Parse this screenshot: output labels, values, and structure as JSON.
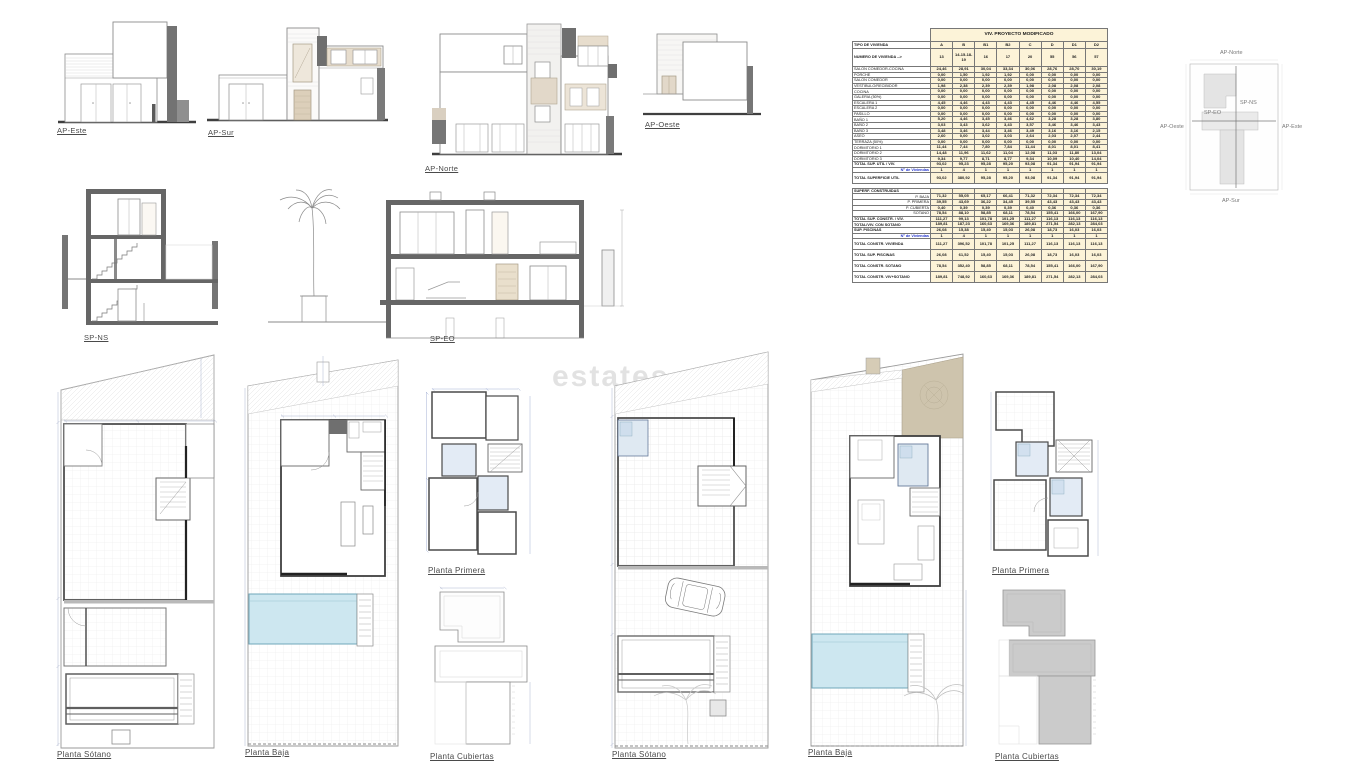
{
  "watermark": {
    "text": "estates.c"
  },
  "elevations": [
    {
      "label": "AP-Este"
    },
    {
      "label": "AP-Sur"
    },
    {
      "label": "AP-Norte"
    },
    {
      "label": "AP-Oeste"
    }
  ],
  "sections": [
    {
      "label": "SP-NS"
    },
    {
      "label": "SP-EO"
    }
  ],
  "site_key": {
    "north": "AP-Norte",
    "south": "AP-Sur",
    "west": "AP-Oeste",
    "east": "AP-Este",
    "section_vertical": "SP-NS",
    "section_horizontal": "SP-EO"
  },
  "plans": [
    {
      "label": "Planta Sótano"
    },
    {
      "label": "Planta Baja"
    },
    {
      "label": "Planta Primera"
    },
    {
      "label": "Planta Cubiertas"
    },
    {
      "label": "Planta Sótano"
    },
    {
      "label": "Planta Baja"
    },
    {
      "label": "Planta Primera"
    },
    {
      "label": "Planta Cubiertas"
    }
  ],
  "colors": {
    "table_fill": "#fcf3d8",
    "pool_blue": "#cde7f0",
    "tan": "#cec4ad",
    "wall_dark": "#666666",
    "accent_blue_text": "#2233cc"
  },
  "table": {
    "title": "VIV. PROYECTO MODIFICADO",
    "type_label": "TIPO DE VIVIENDA",
    "columns": [
      "A",
      "B",
      "B1",
      "B2",
      "C",
      "D",
      "D1",
      "D2"
    ],
    "numero_label": "NUMERO DE VIVIENDA -->",
    "numeros": [
      "13",
      "14-15-18-19",
      "16",
      "17",
      "20",
      "55",
      "56",
      "57"
    ],
    "rows": [
      {
        "label": "SALON COMEDOR-COCINA",
        "style": "normal",
        "values": [
          "24,46",
          "28,91",
          "30,04",
          "33,34",
          "30,06",
          "28,76",
          "28,70",
          "30,19"
        ]
      },
      {
        "label": "PORCHE",
        "style": "normal",
        "values": [
          "0,00",
          "1,50",
          "1,92",
          "1,92",
          "0,00",
          "0,00",
          "0,00",
          "0,00"
        ]
      },
      {
        "label": "SALON COMEDOR",
        "style": "normal",
        "values": [
          "0,00",
          "0,00",
          "0,00",
          "0,00",
          "0,00",
          "0,00",
          "0,00",
          "0,00"
        ]
      },
      {
        "label": "VESTIBULO/RECIBIDOR",
        "style": "normal",
        "values": [
          "1,98",
          "2,38",
          "2,39",
          "2,39",
          "1,98",
          "2,08",
          "2,08",
          "2,08"
        ]
      },
      {
        "label": "COCINA",
        "style": "normal",
        "values": [
          "0,00",
          "0,00",
          "0,00",
          "0,00",
          "0,00",
          "0,00",
          "0,00",
          "0,00"
        ]
      },
      {
        "label": "GALERIA (50%)",
        "style": "normal",
        "values": [
          "0,00",
          "0,00",
          "0,00",
          "0,00",
          "0,00",
          "0,00",
          "0,00",
          "0,00"
        ]
      },
      {
        "label": "ESCALERA 1",
        "style": "normal",
        "values": [
          "4,45",
          "4,46",
          "4,43",
          "4,43",
          "4,45",
          "4,46",
          "4,46",
          "4,55"
        ]
      },
      {
        "label": "ESCALERA 2",
        "style": "normal",
        "values": [
          "0,00",
          "0,00",
          "0,00",
          "0,00",
          "0,00",
          "0,00",
          "0,00",
          "0,00"
        ]
      },
      {
        "label": "PASILLO",
        "style": "normal",
        "values": [
          "0,00",
          "0,00",
          "0,00",
          "0,00",
          "0,00",
          "0,00",
          "0,00",
          "0,00"
        ]
      },
      {
        "label": "BAÑO 1",
        "style": "normal",
        "values": [
          "5,20",
          "4,46",
          "3,45",
          "3,46",
          "4,62",
          "3,28",
          "3,28",
          "3,80"
        ]
      },
      {
        "label": "BAÑO 2",
        "style": "normal",
        "values": [
          "3,03",
          "3,43",
          "3,62",
          "3,43",
          "3,57",
          "3,46",
          "3,46",
          "3,43"
        ]
      },
      {
        "label": "BAÑO 3",
        "style": "normal",
        "values": [
          "3,48",
          "3,46",
          "3,44",
          "3,46",
          "3,49",
          "3,16",
          "3,16",
          "2,15"
        ]
      },
      {
        "label": "ASEO",
        "style": "normal",
        "values": [
          "2,60",
          "0,00",
          "3,02",
          "3,03",
          "2,64",
          "2,03",
          "2,07",
          "2,44"
        ]
      },
      {
        "label": "TERRAZA (50%)",
        "style": "normal",
        "values": [
          "0,00",
          "0,00",
          "0,00",
          "0,00",
          "0,00",
          "0,00",
          "0,00",
          "0,00"
        ]
      },
      {
        "label": "DORMITORIO 1",
        "style": "normal",
        "values": [
          "11,44",
          "7,44",
          "7,80",
          "7,84",
          "11,44",
          "8,01",
          "8,01",
          "8,41"
        ]
      },
      {
        "label": "DORMITORIO 2",
        "style": "normal",
        "values": [
          "14,48",
          "11,96",
          "11,62",
          "11,04",
          "12,08",
          "11,03",
          "11,80",
          "13,04"
        ]
      },
      {
        "label": "DORMITORIO 3",
        "style": "normal",
        "values": [
          "9,34",
          "9,77",
          "8,71",
          "8,77",
          "9,34",
          "10,09",
          "10,40",
          "14,04"
        ]
      },
      {
        "label": "TOTAL SUP. UTIL / VIV.",
        "style": "total",
        "values": [
          "93,02",
          "95,23",
          "95,28",
          "95,20",
          "93,08",
          "91,34",
          "91,94",
          "91,94"
        ]
      },
      {
        "label": "Nº de Viviendas",
        "style": "blue",
        "values": [
          "1",
          "4",
          "1",
          "1",
          "1",
          "1",
          "1",
          "1"
        ]
      },
      {
        "label": "TOTAL SUPERFICIE UTIL",
        "style": "total tall",
        "values": [
          "93,02",
          "380,92",
          "95,28",
          "95,20",
          "93,08",
          "91,34",
          "91,94",
          "91,94"
        ]
      },
      {
        "label": "",
        "style": "spacer",
        "values": [
          "",
          "",
          "",
          "",
          "",
          "",
          "",
          ""
        ]
      },
      {
        "label": "SUPERF. CONSTRUIDAS",
        "style": "section",
        "values": [
          "",
          "",
          "",
          "",
          "",
          "",
          "",
          ""
        ]
      },
      {
        "label": "P. BAJA",
        "style": "sub",
        "values": [
          "71,32",
          "55,05",
          "65,17",
          "66,41",
          "71,32",
          "72,34",
          "72,34",
          "72,34"
        ]
      },
      {
        "label": "P. PRIMERA",
        "style": "sub",
        "values": [
          "39,55",
          "43,69",
          "36,22",
          "34,45",
          "39,55",
          "43,43",
          "43,43",
          "43,43"
        ]
      },
      {
        "label": "P. CUBIERTA",
        "style": "sub",
        "values": [
          "0,40",
          "0,39",
          "0,39",
          "0,39",
          "0,40",
          "0,36",
          "0,36",
          "0,36"
        ]
      },
      {
        "label": "SOTANO",
        "style": "sub",
        "values": [
          "78,54",
          "88,10",
          "58,85",
          "68,11",
          "78,54",
          "155,41",
          "166,00",
          "167,90"
        ]
      },
      {
        "label": "TOTAL SUP. CONSTR. / VIV.",
        "style": "total",
        "values": [
          "111,27",
          "99,13",
          "101,78",
          "101,25",
          "111,27",
          "116,13",
          "116,13",
          "116,13"
        ]
      },
      {
        "label": "TOTAL/VIV. CON SOTANO",
        "style": "total",
        "values": [
          "189,81",
          "187,23",
          "160,63",
          "169,36",
          "189,81",
          "271,54",
          "282,13",
          "284,03"
        ]
      },
      {
        "label": "SUP. PISCINAS",
        "style": "total",
        "values": [
          "26,08",
          "15,38",
          "15,40",
          "15,03",
          "26,08",
          "18,73",
          "16,03",
          "16,03"
        ]
      },
      {
        "label": "Nº de Viviendas",
        "style": "blue",
        "values": [
          "1",
          "4",
          "1",
          "1",
          "1",
          "1",
          "1",
          "1"
        ]
      },
      {
        "label": "TOTAL CONSTR. VIVIENDA",
        "style": "total tall",
        "values": [
          "111,27",
          "396,52",
          "101,78",
          "101,25",
          "111,27",
          "116,13",
          "116,13",
          "116,13"
        ]
      },
      {
        "label": "TOTAL SUP. PISCINAS",
        "style": "total tall",
        "values": [
          "26,08",
          "61,52",
          "15,40",
          "15,03",
          "26,08",
          "18,73",
          "16,03",
          "16,03"
        ]
      },
      {
        "label": "TOTAL CONSTR. SOTANO",
        "style": "total tall",
        "values": [
          "78,54",
          "352,40",
          "58,85",
          "68,11",
          "78,54",
          "155,41",
          "166,00",
          "167,90"
        ]
      },
      {
        "label": "TOTAL CONSTR. VIV+SOTANO",
        "style": "total tall",
        "values": [
          "189,81",
          "748,92",
          "160,63",
          "169,36",
          "189,81",
          "271,54",
          "282,13",
          "284,03"
        ]
      }
    ]
  }
}
